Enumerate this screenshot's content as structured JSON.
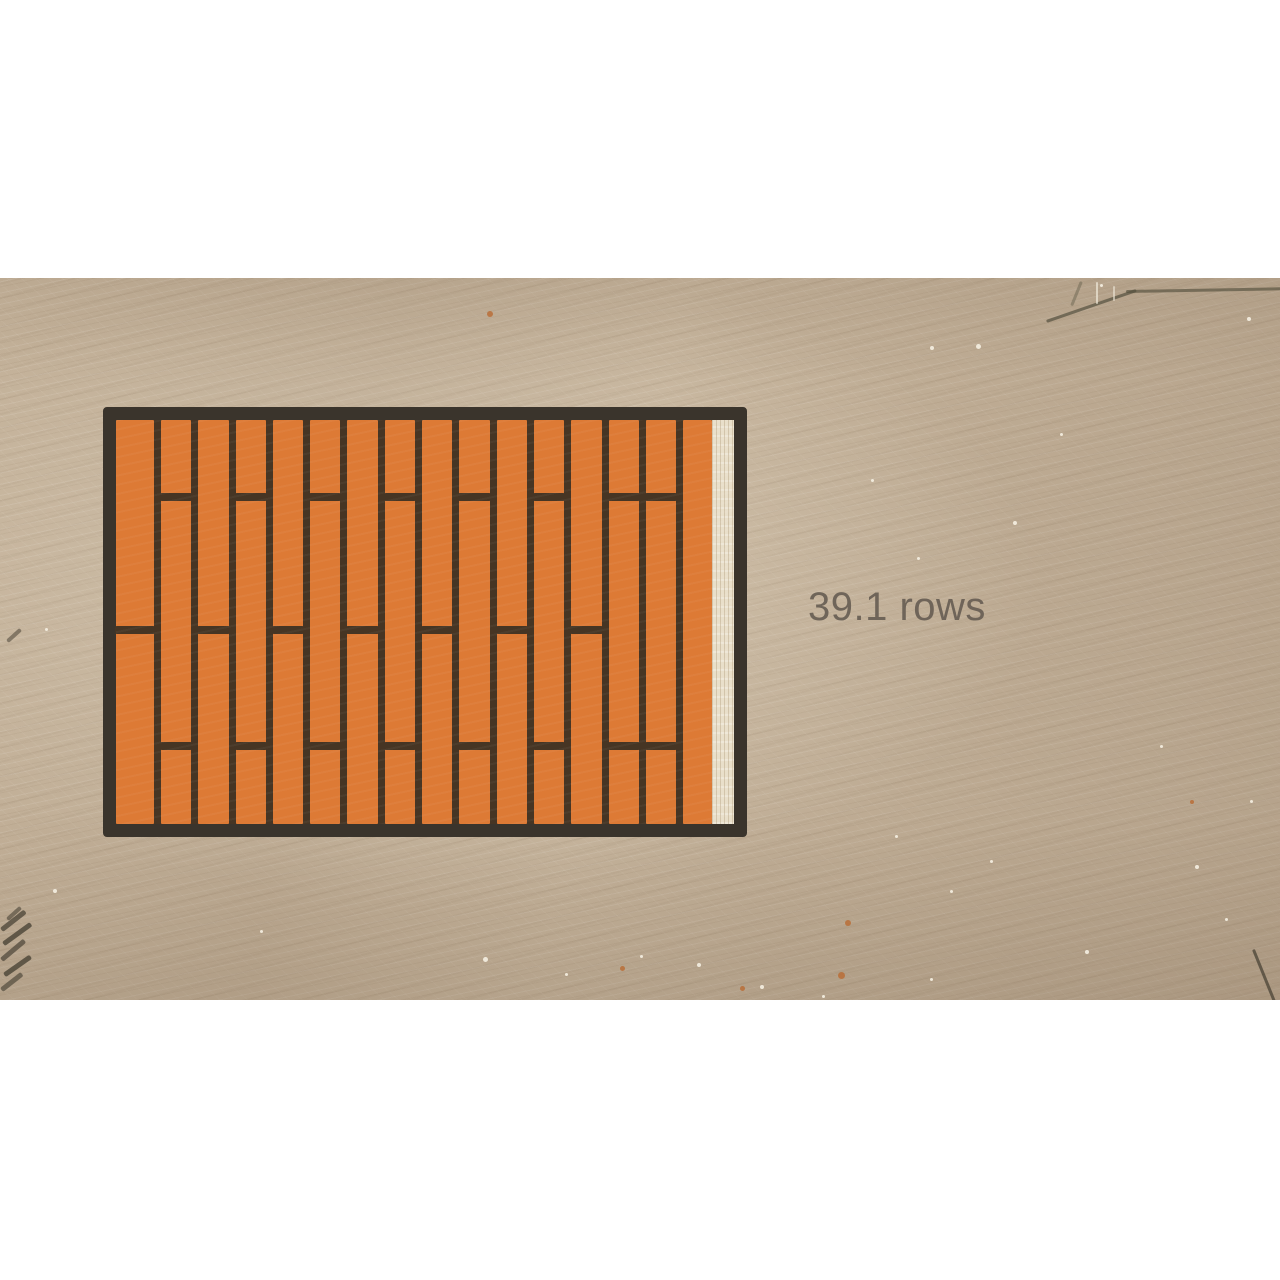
{
  "frame": {
    "type": "educational-video-frame",
    "label": {
      "text": "39.1 rows"
    }
  },
  "diagram": {
    "kind": "staggered-plank-floor",
    "has_partial_gap_column": true,
    "joint_fractions": {
      "top": 0.191,
      "mid": 0.521,
      "bottom": 0.806
    },
    "columns": [
      {
        "w": 1.25,
        "joints": [
          0.521
        ]
      },
      {
        "w": 1.0,
        "joints": [
          0.191,
          0.806
        ]
      },
      {
        "w": 1.0,
        "joints": [
          0.521
        ]
      },
      {
        "w": 1.0,
        "joints": [
          0.191,
          0.806
        ]
      },
      {
        "w": 1.0,
        "joints": [
          0.521
        ]
      },
      {
        "w": 1.0,
        "joints": [
          0.191,
          0.806
        ]
      },
      {
        "w": 1.0,
        "joints": [
          0.521
        ]
      },
      {
        "w": 1.0,
        "joints": [
          0.191,
          0.806
        ]
      },
      {
        "w": 1.0,
        "joints": [
          0.521
        ]
      },
      {
        "w": 1.0,
        "joints": [
          0.191,
          0.806
        ]
      },
      {
        "w": 1.0,
        "joints": [
          0.521
        ]
      },
      {
        "w": 1.0,
        "joints": [
          0.191,
          0.806
        ]
      },
      {
        "w": 1.0,
        "joints": [
          0.521
        ]
      },
      {
        "w": 1.0,
        "joints": [
          0.191,
          0.806
        ]
      },
      {
        "w": 1.0,
        "joints": [
          0.191,
          0.806
        ]
      },
      {
        "w": 0.95,
        "joints": []
      }
    ]
  },
  "colors": {
    "letterbox": "#ffffff",
    "wood_base": "#c4b29a",
    "plank": "#dd7a35",
    "plank_seam": "#463524",
    "outline": "#3a342c",
    "gap_strip": "#e9dfca",
    "label_text": "#6b6156",
    "speckle": "#f5efe2",
    "rust": "#b96a32"
  },
  "decor": {
    "speckles": [
      [
        930,
        68,
        4
      ],
      [
        976,
        66,
        5
      ],
      [
        1247,
        39,
        4
      ],
      [
        1100,
        6,
        3
      ],
      [
        1013,
        243,
        4
      ],
      [
        917,
        279,
        3
      ],
      [
        1160,
        467,
        3
      ],
      [
        1195,
        587,
        4
      ],
      [
        1085,
        672,
        4
      ],
      [
        950,
        612,
        3
      ],
      [
        895,
        557,
        3
      ],
      [
        990,
        582,
        3
      ],
      [
        1250,
        522,
        3
      ],
      [
        760,
        707,
        4
      ],
      [
        697,
        685,
        4
      ],
      [
        565,
        695,
        3
      ],
      [
        483,
        679,
        5
      ],
      [
        822,
        717,
        3
      ],
      [
        53,
        611,
        4
      ],
      [
        45,
        350,
        3
      ],
      [
        260,
        652,
        3
      ],
      [
        640,
        677,
        3
      ],
      [
        871,
        201,
        3
      ],
      [
        1060,
        155,
        3
      ],
      [
        1225,
        640,
        3
      ],
      [
        930,
        700,
        3
      ]
    ],
    "rust_dots": [
      [
        487,
        33,
        6
      ],
      [
        620,
        688,
        5
      ],
      [
        838,
        694,
        7
      ],
      [
        845,
        642,
        6
      ],
      [
        740,
        708,
        5
      ],
      [
        1190,
        522,
        4
      ]
    ],
    "strokes": [
      [
        1046,
        42,
        95,
        3,
        -19,
        "#54503e",
        0.7
      ],
      [
        1126,
        12,
        156,
        3,
        -1,
        "#54503e",
        0.65
      ],
      [
        1080,
        3,
        3,
        26,
        22,
        "#6a6450",
        0.5
      ],
      [
        1096,
        4,
        2,
        22,
        0,
        "#efe8d8",
        0.7
      ],
      [
        1113,
        8,
        2,
        15,
        0,
        "#efe8d8",
        0.6
      ],
      [
        6,
        362,
        18,
        4,
        -42,
        "#4a4336",
        0.55
      ],
      [
        0,
        650,
        30,
        5,
        -38,
        "#4a4336",
        0.75
      ],
      [
        2,
        664,
        34,
        5,
        -36,
        "#4a4336",
        0.8
      ],
      [
        0,
        680,
        30,
        5,
        -40,
        "#4a4336",
        0.7
      ],
      [
        3,
        695,
        32,
        5,
        -35,
        "#4a4336",
        0.8
      ],
      [
        0,
        710,
        26,
        5,
        -38,
        "#4a4336",
        0.65
      ],
      [
        6,
        640,
        18,
        4,
        -42,
        "#4a4336",
        0.6
      ],
      [
        1252,
        672,
        3,
        58,
        -22,
        "#4a4336",
        0.75
      ]
    ]
  }
}
